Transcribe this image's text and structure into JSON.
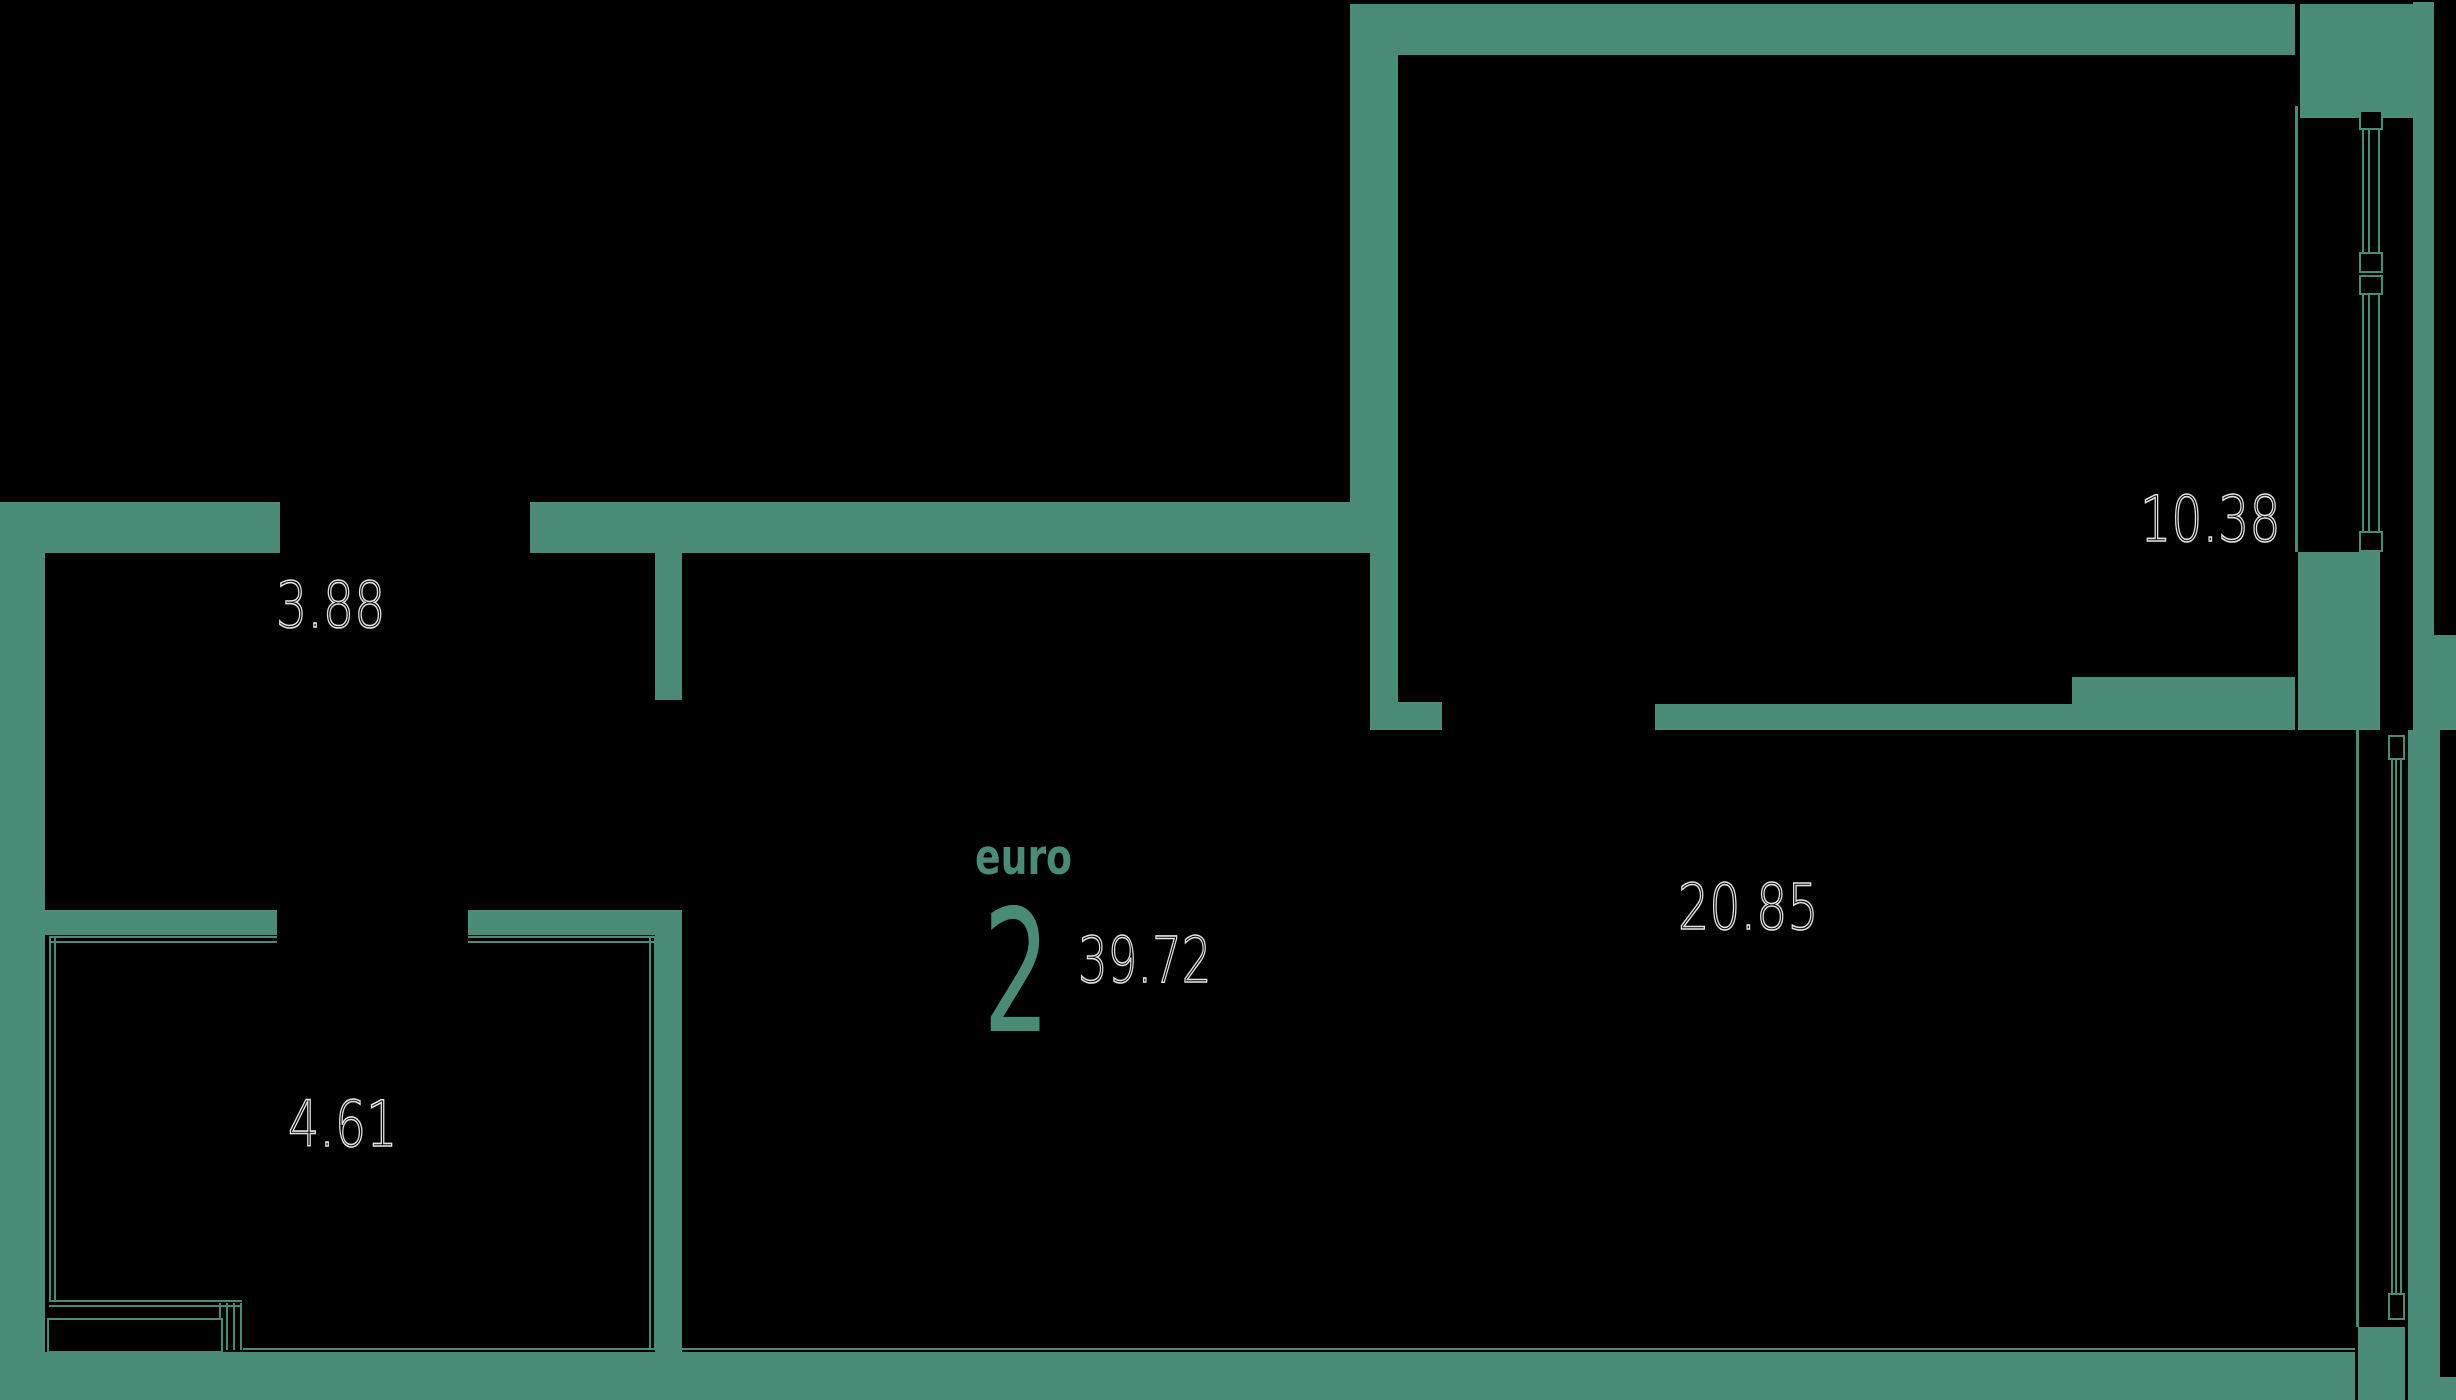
{
  "plan": {
    "title": {
      "type_label": "euro",
      "type_number": "2",
      "total_area": "39.72"
    },
    "rooms": [
      {
        "id": "hallway",
        "area": "3.88"
      },
      {
        "id": "bathroom",
        "area": "4.61"
      },
      {
        "id": "bedroom",
        "area": "10.38"
      },
      {
        "id": "living",
        "area": "20.85"
      }
    ],
    "colors": {
      "wall": "#4a8b78",
      "outline_text": "#e3e3e3",
      "background": "#000000"
    }
  }
}
